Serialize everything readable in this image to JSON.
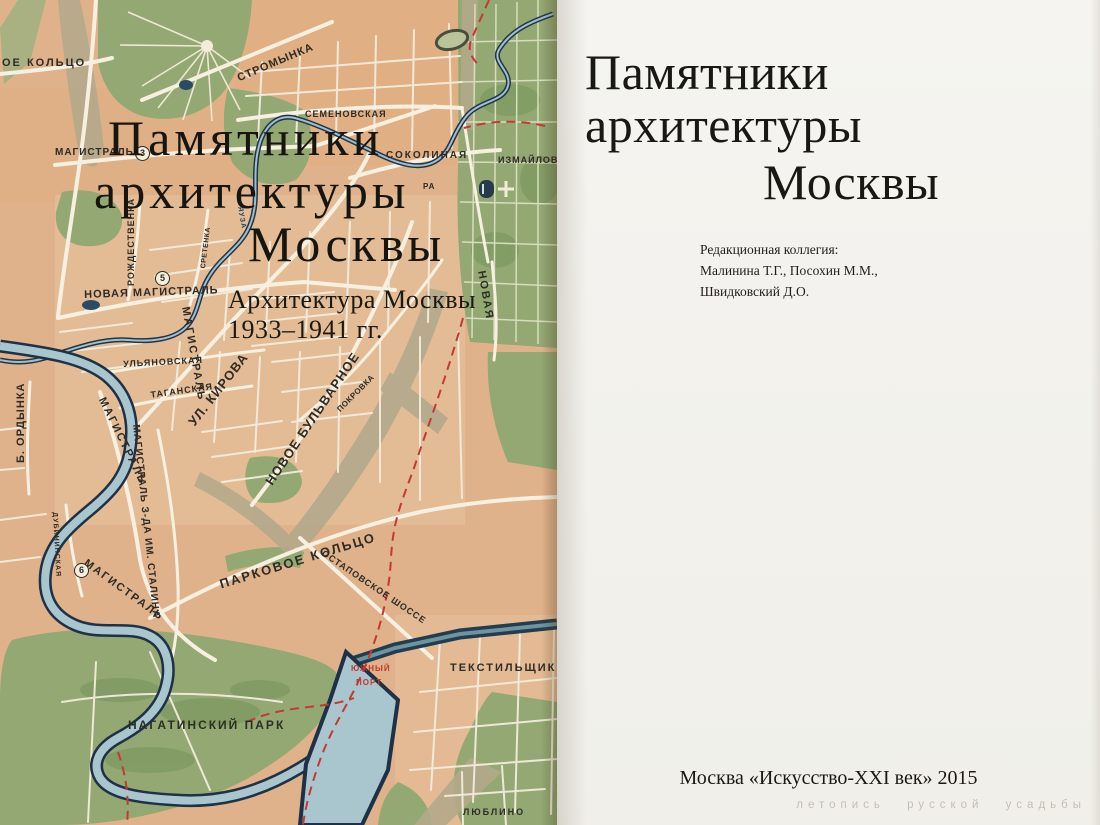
{
  "cover": {
    "title_line1": "Памятники",
    "title_line2": "архитектуры",
    "title_line3": "Москвы",
    "subtitle_line1": "Архитектура Москвы",
    "subtitle_line2": "1933–1941 гг.",
    "map_labels": [
      {
        "text": "ОЕ КОЛЬЦО",
        "x": 2,
        "y": 58,
        "rot": 0,
        "size": 11,
        "ls": 2
      },
      {
        "text": "СТРОМЫНКА",
        "x": 236,
        "y": 74,
        "rot": -23,
        "size": 11,
        "ls": 1
      },
      {
        "text": "СЕМЕНОВСКАЯ",
        "x": 305,
        "y": 110,
        "rot": 0,
        "size": 9,
        "ls": 1
      },
      {
        "text": "СОКОЛИНАЯ",
        "x": 386,
        "y": 151,
        "rot": 0,
        "size": 10,
        "ls": 2
      },
      {
        "text": "ИЗМАЙЛОВО",
        "x": 498,
        "y": 156,
        "rot": 0,
        "size": 9,
        "ls": 1
      },
      {
        "text": "РА",
        "x": 423,
        "y": 183,
        "rot": 0,
        "size": 8,
        "ls": 1
      },
      {
        "text": "МАГИСТРАЛЬ",
        "x": 55,
        "y": 148,
        "rot": 0,
        "size": 10,
        "ls": 1
      },
      {
        "type": "badge",
        "text": "3",
        "x": 135,
        "y": 146
      },
      {
        "text": "РОЖДЕСТВЕНКА",
        "x": 127,
        "y": 286,
        "rot": -90,
        "size": 9,
        "ls": 1
      },
      {
        "text": "СРЕТЕНКА",
        "x": 200,
        "y": 268,
        "rot": -83,
        "size": 7,
        "ls": 0.5
      },
      {
        "text": "УЛ. КИРОВА",
        "x": 186,
        "y": 420,
        "rot": -52,
        "size": 13,
        "ls": 1
      },
      {
        "text": "ПОКРОВКА",
        "x": 336,
        "y": 408,
        "rot": -45,
        "size": 8,
        "ls": 0.5
      },
      {
        "text": "НОВАЯ",
        "x": 486,
        "y": 270,
        "rot": 80,
        "size": 11,
        "ls": 2
      },
      {
        "text": "НОВАЯ МАГИСТРАЛЬ",
        "x": 84,
        "y": 290,
        "rot": -2,
        "size": 11,
        "ls": 1
      },
      {
        "type": "badge",
        "text": "5",
        "x": 155,
        "y": 271
      },
      {
        "text": "ЯУЗА",
        "x": 243,
        "y": 206,
        "rot": 80,
        "size": 7,
        "ls": 1,
        "color": "#27415c"
      },
      {
        "text": "УЛЬЯНОВСКАЯ",
        "x": 123,
        "y": 360,
        "rot": -3,
        "size": 9,
        "ls": 1
      },
      {
        "text": "ТАГАНСКАЯ",
        "x": 150,
        "y": 391,
        "rot": -8,
        "size": 9,
        "ls": 1
      },
      {
        "text": "МАГИСТРАЛЬ",
        "x": 106,
        "y": 396,
        "rot": 64,
        "size": 11,
        "ls": 2
      },
      {
        "text": "МАГИСТРАЛЬ",
        "x": 190,
        "y": 306,
        "rot": 80,
        "size": 11,
        "ls": 2
      },
      {
        "text": "НОВОЕ БУЛЬВАРНОЕ",
        "x": 263,
        "y": 480,
        "rot": -56,
        "size": 13,
        "ls": 1
      },
      {
        "text": "МАГИСТРАЛЬ З-ДА ИМ. СТАЛИНА",
        "x": 140,
        "y": 424,
        "rot": 84,
        "size": 10,
        "ls": 1
      },
      {
        "text": "Б. ОРДЫНКА",
        "x": 16,
        "y": 463,
        "rot": -90,
        "size": 11,
        "ls": 1
      },
      {
        "text": "ДУБИНИНСКАЯ",
        "x": 58,
        "y": 512,
        "rot": 87,
        "size": 7,
        "ls": 1
      },
      {
        "text": "МАГИСТРАЛЬ",
        "x": 88,
        "y": 558,
        "rot": 36,
        "size": 11,
        "ls": 2
      },
      {
        "type": "badge",
        "text": "6",
        "x": 74,
        "y": 563
      },
      {
        "text": "ПАРКОВОЕ КОЛЬЦО",
        "x": 218,
        "y": 578,
        "rot": -17,
        "size": 13,
        "ls": 2
      },
      {
        "text": "ОСТАПОВСКОЕ ШОССЕ",
        "x": 325,
        "y": 549,
        "rot": 34,
        "size": 9,
        "ls": 1
      },
      {
        "text": "ЮЖНЫЙ",
        "x": 351,
        "y": 665,
        "rot": 0,
        "size": 8,
        "ls": 1,
        "color": "#c0392b"
      },
      {
        "text": "ПОРТ",
        "x": 356,
        "y": 679,
        "rot": 0,
        "size": 8,
        "ls": 1,
        "color": "#c0392b"
      },
      {
        "text": "ТЕКСТИЛЬЩИКИ",
        "x": 450,
        "y": 663,
        "rot": 0,
        "size": 11,
        "ls": 2
      },
      {
        "text": "НАГАТИНСКИЙ ПАРК",
        "x": 128,
        "y": 719,
        "rot": 0,
        "size": 12,
        "ls": 2,
        "color": "#2c2f24"
      },
      {
        "text": "ЛЮБЛИНО",
        "x": 463,
        "y": 808,
        "rot": 0,
        "size": 9,
        "ls": 2
      }
    ]
  },
  "title_page": {
    "title_line1": "Памятники",
    "title_line2": "архитектуры",
    "title_line3": "Москвы",
    "editors_heading": "Редакционная коллегия:",
    "editors_line1": "Малинина Т.Г., Посохин М.М.,",
    "editors_line2": "Швидковский Д.О.",
    "imprint": "Москва «Искусство-XXI век» 2015",
    "watermark": "летопись русской усадьбы"
  },
  "colors": {
    "map_base": "#dfb28b",
    "park_green": "#93a873",
    "water_light": "#a9c6cf",
    "water_dark": "#1e3146",
    "boundary_red": "#c23a33",
    "accent_red": "#c0392b",
    "paper": "#f3f1ec",
    "label": "#2f2b26"
  }
}
